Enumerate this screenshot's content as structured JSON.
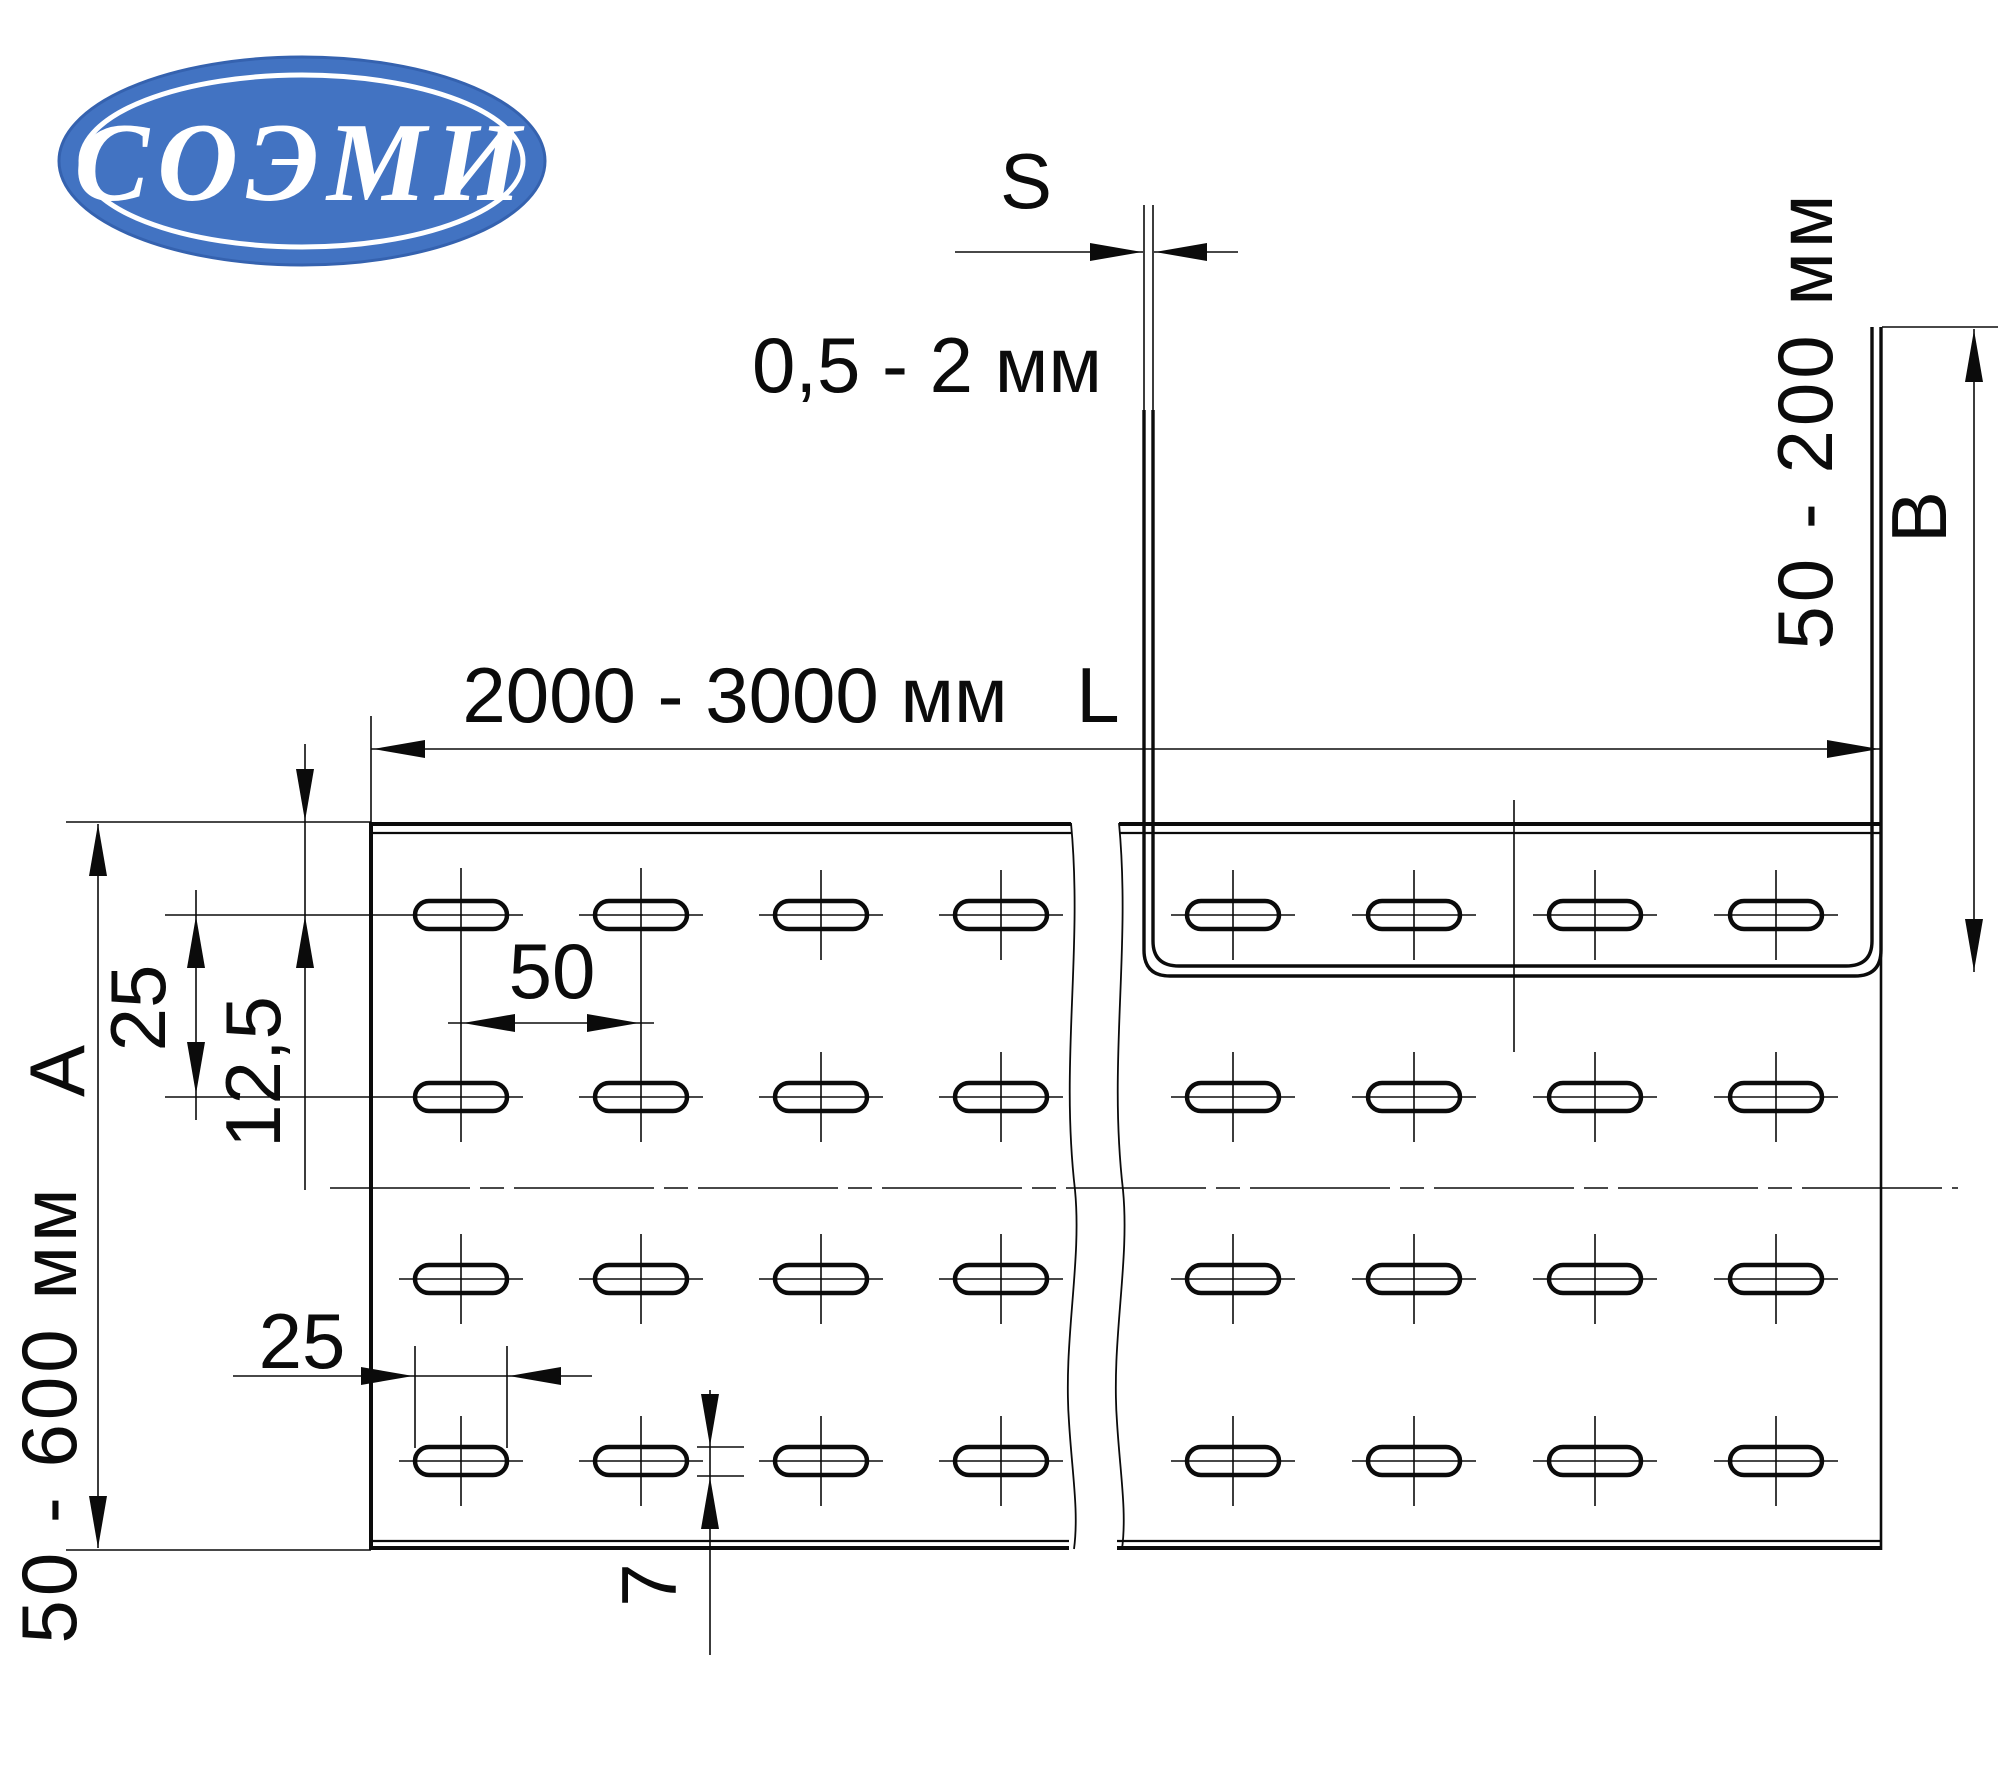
{
  "logo": {
    "text": "СОЭМИ",
    "bg_color": "#4273c2",
    "text_color": "#ffffff"
  },
  "cross_section": {
    "thickness_label": "S",
    "thickness_range": "0,5 - 2 мм",
    "height_range": "50 - 200 мм",
    "height_label": "B"
  },
  "plan_view": {
    "length_range": "2000 - 3000 мм",
    "length_label": "L",
    "width_range": "50 - 600 мм",
    "width_label": "A",
    "row_pitch": "25",
    "first_row_offset": "12,5",
    "column_pitch": "50",
    "slot_length": "25",
    "slot_width": "7"
  }
}
